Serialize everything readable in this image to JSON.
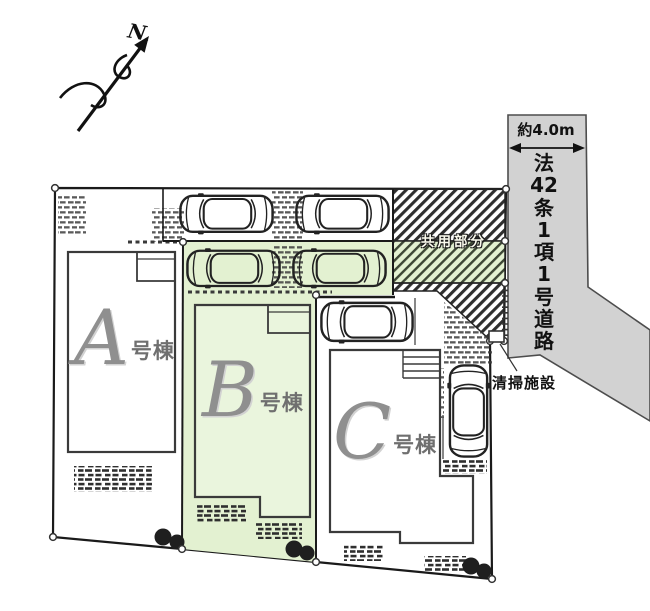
{
  "plan": {
    "north_label": "N",
    "road": {
      "width_label": "約4.0m",
      "name_lines": [
        "法",
        "42",
        "条",
        "1",
        "項",
        "1",
        "号",
        "道",
        "路"
      ]
    },
    "areas": {
      "common_label": "共用部分",
      "cleaning_label": "清掃施設"
    },
    "buildings": [
      {
        "letter": "A",
        "suffix": "号棟"
      },
      {
        "letter": "B",
        "suffix": "号棟"
      },
      {
        "letter": "C",
        "suffix": "号棟"
      }
    ],
    "colors": {
      "lot_green": "#e3f1d1",
      "building_green": "#eaf5dd",
      "road_gray": "#d2d2d2",
      "hatch_dark": "#2e2e2e",
      "line_dark": "#1a1a1a"
    }
  }
}
